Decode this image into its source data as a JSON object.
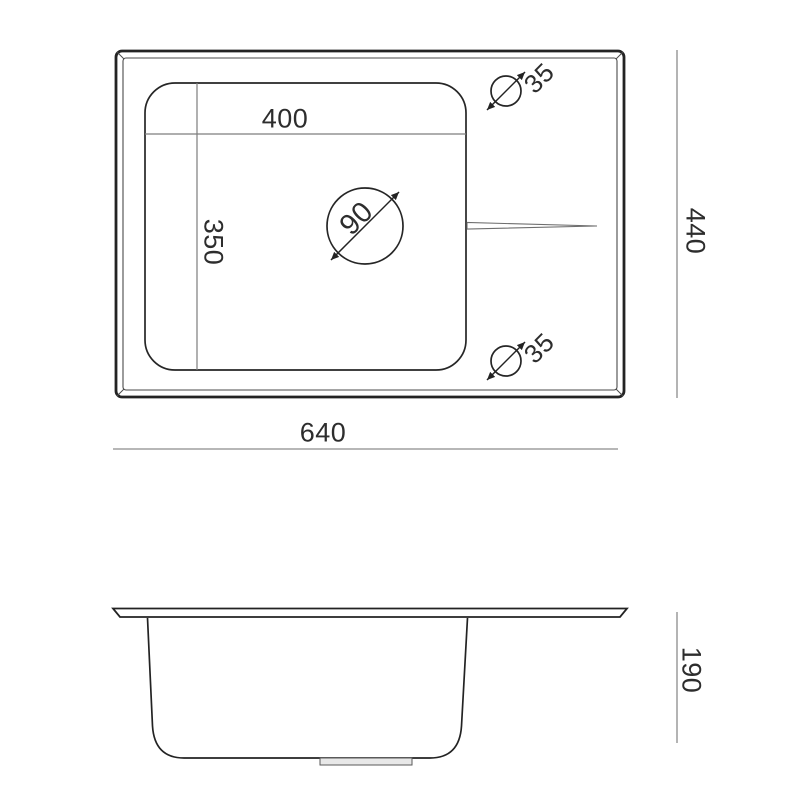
{
  "drawing": {
    "top_view": {
      "inner_width": "400",
      "inner_depth": "350",
      "drain_diameter": "90",
      "tap_hole_top_diameter": "35",
      "tap_hole_bottom_diameter": "35",
      "overall_width": "640",
      "overall_depth": "440"
    },
    "side_view": {
      "bowl_depth": "190"
    },
    "colors": {
      "outline": "#232323",
      "dimension_line": "#8c8c8c",
      "text": "#2d2d2d",
      "background": "#ffffff",
      "drain_tab_fill": "#e8e8e8"
    }
  }
}
